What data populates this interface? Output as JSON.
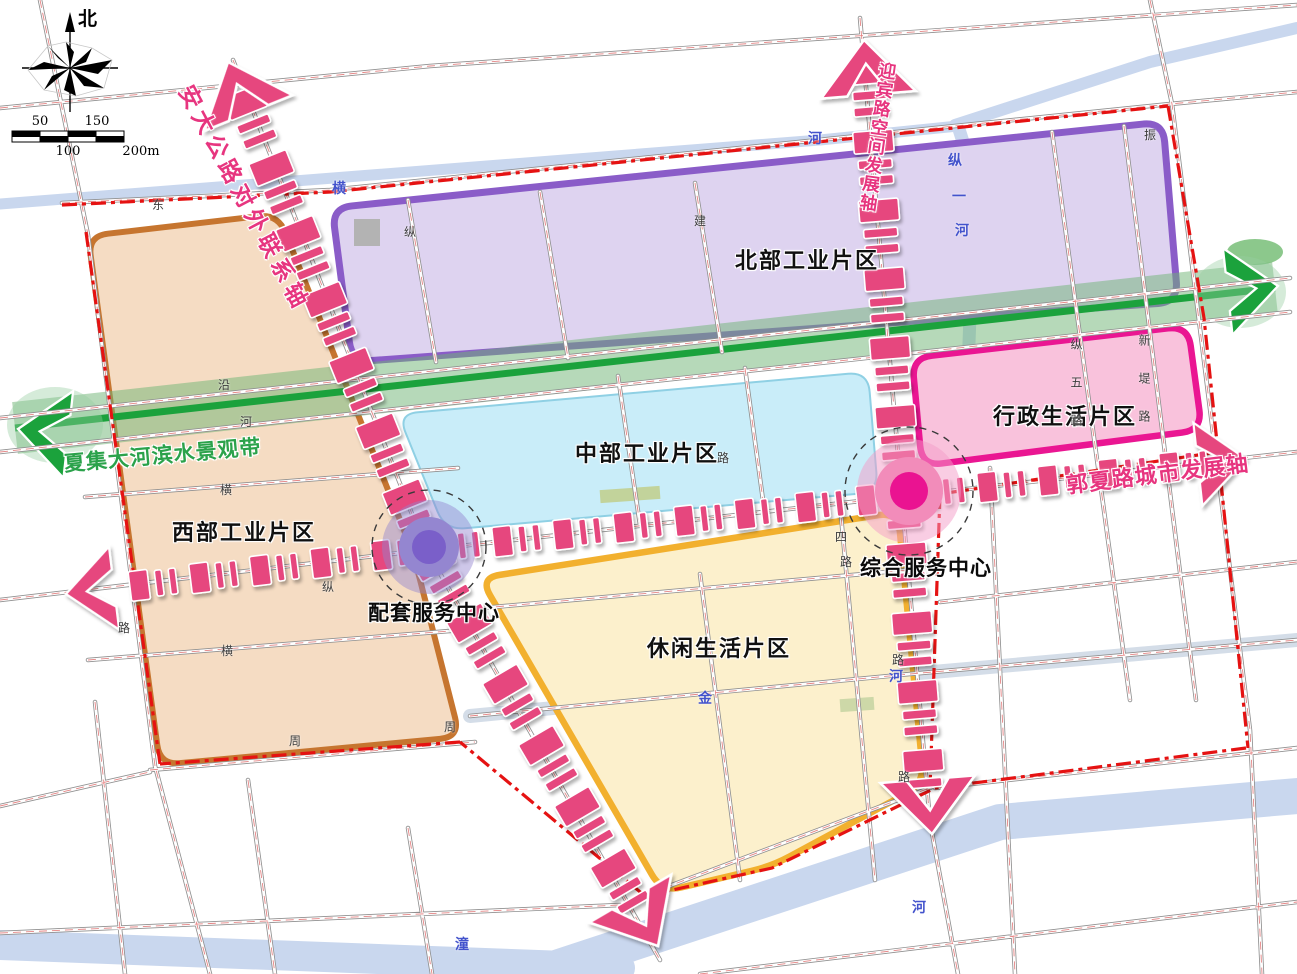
{
  "compass": {
    "north_label": "北"
  },
  "scalebar": {
    "top": [
      {
        "t": "50",
        "x": 40
      },
      {
        "t": "150",
        "x": 97
      }
    ],
    "bottom": [
      {
        "t": "100",
        "x": 68
      },
      {
        "t": "200m",
        "x": 141
      }
    ]
  },
  "zones": [
    {
      "id": "north-industrial",
      "label": "北部工业片区",
      "lx": 735,
      "ly": 243,
      "fill": "#ded3f0",
      "border": "#8a5cc8"
    },
    {
      "id": "west-industrial",
      "label": "西部工业片区",
      "lx": 172,
      "ly": 515,
      "fill": "#f5dcc3",
      "border": "#c6752f"
    },
    {
      "id": "central-industrial",
      "label": "中部工业片区",
      "lx": 575,
      "ly": 436,
      "fill": "#c9edf9",
      "border": "#8fd0e4"
    },
    {
      "id": "admin-living",
      "label": "行政生活片区",
      "lx": 993,
      "ly": 399,
      "fill": "#f9c2dc",
      "border": "#ea1692"
    },
    {
      "id": "leisure-living",
      "label": "休闲生活片区",
      "lx": 647,
      "ly": 631,
      "fill": "#fcf0cc",
      "border": "#f2b02e"
    }
  ],
  "axes": [
    {
      "id": "anda-axis",
      "label": "安大公路对外联系轴",
      "color": "#e7357f"
    },
    {
      "id": "yingbin-axis",
      "label": "迎宾路空间发展轴",
      "color": "#e7357f"
    },
    {
      "id": "guoxia-axis",
      "label": "郭夏路城市发展轴",
      "color": "#e7357f"
    },
    {
      "id": "waterfront-belt",
      "label": "夏集大河滨水景观带",
      "color": "#2ba24b"
    }
  ],
  "centers": [
    {
      "id": "supporting-service-center",
      "label": "配套服务中心",
      "lx": 368,
      "ly": 597,
      "x": 429,
      "y": 547,
      "outer": "rgba(147,131,206,0.45)",
      "mid": "#9486d0",
      "inner": "#7a5fc9"
    },
    {
      "id": "comprehensive-service-center",
      "label": "综合服务中心",
      "lx": 860,
      "ly": 552,
      "x": 909,
      "y": 491,
      "outer": "rgba(244,156,199,0.5)",
      "mid": "#f28cba",
      "inner": "#ea1391"
    }
  ],
  "road_labels": [
    {
      "t": "东",
      "x": 152,
      "y": 196
    },
    {
      "t": "建",
      "x": 694,
      "y": 212
    },
    {
      "t": "纵",
      "x": 404,
      "y": 223
    },
    {
      "t": "振",
      "x": 1144,
      "y": 126
    },
    {
      "t": "沿",
      "x": 218,
      "y": 376
    },
    {
      "t": "河",
      "x": 240,
      "y": 413
    },
    {
      "t": "横",
      "x": 220,
      "y": 481
    },
    {
      "t": "纵",
      "x": 322,
      "y": 578
    },
    {
      "t": "横",
      "x": 221,
      "y": 642
    },
    {
      "t": "路",
      "x": 118,
      "y": 619
    },
    {
      "t": "周",
      "x": 289,
      "y": 732
    },
    {
      "t": "周",
      "x": 444,
      "y": 718
    },
    {
      "t": "路",
      "x": 717,
      "y": 449
    },
    {
      "t": "四",
      "x": 835,
      "y": 528
    },
    {
      "t": "路",
      "x": 840,
      "y": 553
    },
    {
      "t": "路",
      "x": 892,
      "y": 651
    },
    {
      "t": "路",
      "x": 898,
      "y": 768
    },
    {
      "t": "纵五路",
      "x": 1068,
      "y": 338,
      "v": true
    },
    {
      "t": "新堤路",
      "x": 1136,
      "y": 334,
      "v": true
    }
  ],
  "river_labels": [
    {
      "t": "横",
      "x": 332,
      "y": 178
    },
    {
      "t": "河",
      "x": 808,
      "y": 128
    },
    {
      "t": "纵",
      "x": 948,
      "y": 150
    },
    {
      "t": "一",
      "x": 952,
      "y": 186
    },
    {
      "t": "河",
      "x": 955,
      "y": 220
    },
    {
      "t": "河",
      "x": 889,
      "y": 666
    },
    {
      "t": "金",
      "x": 698,
      "y": 688
    },
    {
      "t": "潼",
      "x": 455,
      "y": 934
    },
    {
      "t": "河",
      "x": 912,
      "y": 897
    }
  ],
  "colors": {
    "dash_pink": "#e6477e",
    "boundary_red": "#e51212",
    "green_line": "#1ba23c",
    "green_band": "rgba(110,180,115,0.5)",
    "river": "#c9d7ee",
    "river_light": "#d4dde8",
    "road_casing": "#909090",
    "road_center": "#e07070"
  }
}
